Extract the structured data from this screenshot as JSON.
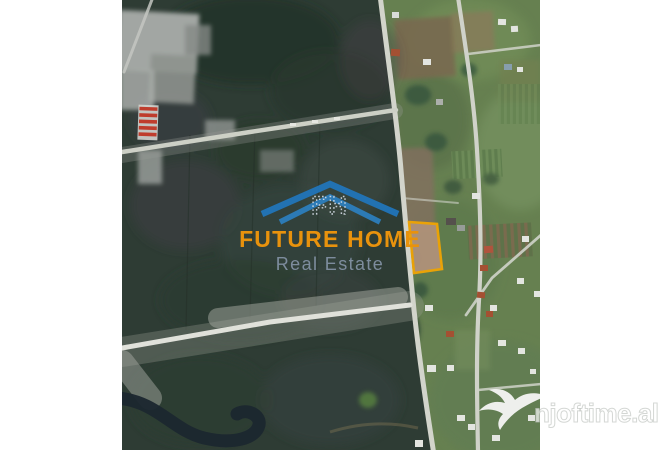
{
  "map": {
    "parcel": {
      "fill": "#B2947A",
      "outline": "#F6A800"
    }
  },
  "logo": {
    "monogram": "FH",
    "title": "FUTURE HOME",
    "subtitle": "Real Estate",
    "title_color": "#E8920D",
    "subtitle_color": "#8493A6",
    "roof_color": "#2176BD"
  },
  "watermark": {
    "text": "njoftime.al"
  }
}
